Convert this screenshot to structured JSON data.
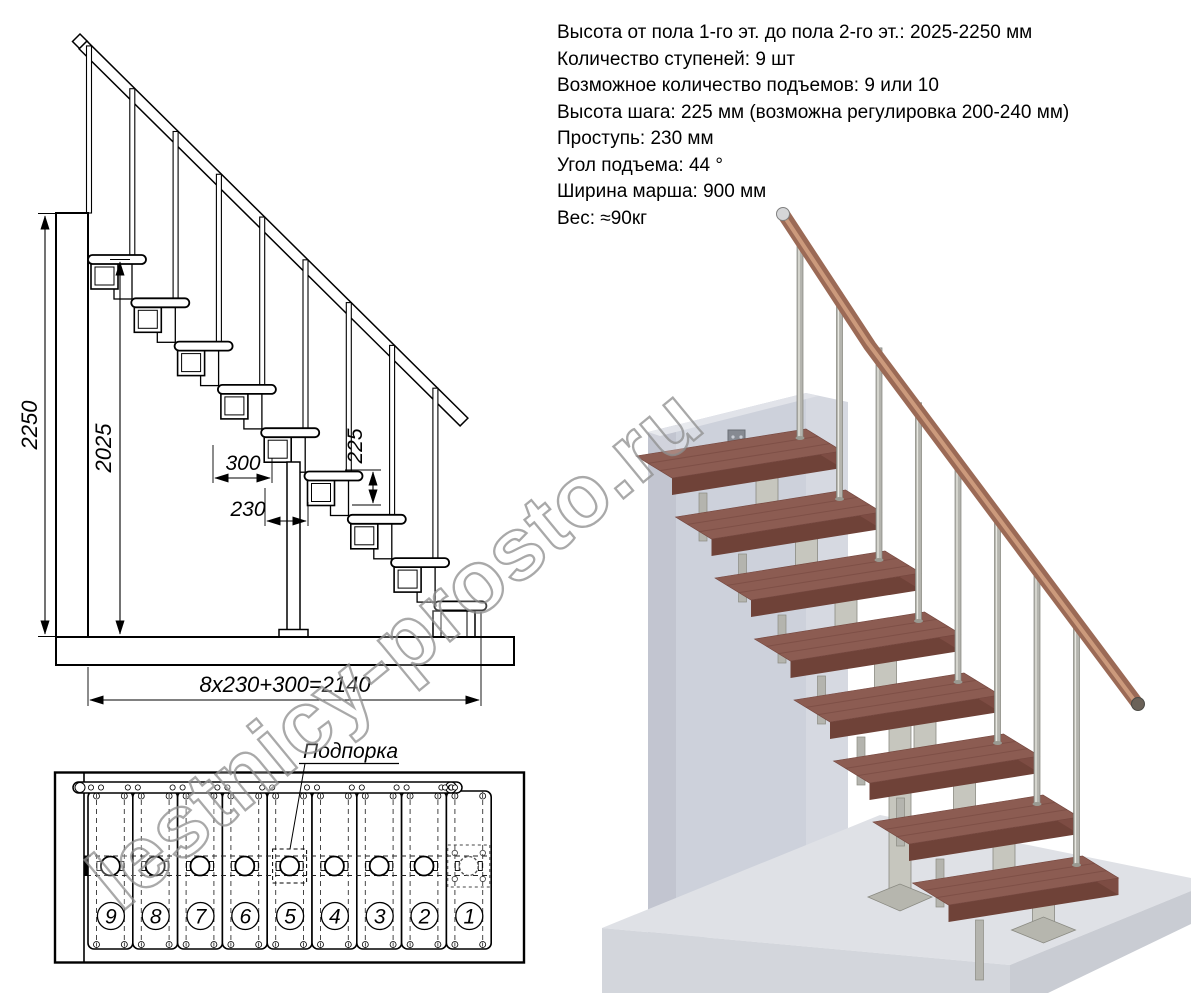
{
  "specs": {
    "lines": [
      "Высота от пола 1-го эт. до пола 2-го эт.: 2025-2250 мм",
      "Количество ступеней: 9 шт",
      "Возможное количество подъемов: 9 или 10",
      "Высота шага: 225 мм (возможна регулировка 200-240 мм)",
      "Проступь: 230 мм",
      "Угол подъема: 44 °",
      "Ширина марша: 900 мм",
      "Вес: ≈90кг"
    ]
  },
  "elevation": {
    "dims": {
      "total_height": "2250",
      "clear_height": "2025",
      "overlap": "300",
      "run": "230",
      "riser": "225",
      "total_run": "8x230+300=2140"
    }
  },
  "plan": {
    "support_label": "Подпорка",
    "step_numbers": [
      "9",
      "8",
      "7",
      "6",
      "5",
      "4",
      "3",
      "2",
      "1"
    ]
  },
  "watermark": {
    "text": "lestnicy-prosto.ru"
  },
  "colors": {
    "tread_top": "#8c5c52",
    "tread_front": "#6f4238",
    "tread_side": "#7d4c43",
    "tread_grain": "#74463e",
    "metal": "#c6c6be",
    "metal_edge": "#8a8a82",
    "baluster": "#b4b4ae",
    "handrail_wood": "#9b6a56",
    "handrail_highlight": "#d2a081",
    "wall_face": "#cdd1db",
    "wall_side": "#b9bcc7",
    "wall_top": "#e1e3e9",
    "floor_top": "#dfe1e6",
    "floor_front_left": "#d3d6dc",
    "floor_front_right": "#c9ccd3",
    "line": "#000000",
    "watermark_gray": "#8f8f8f"
  }
}
